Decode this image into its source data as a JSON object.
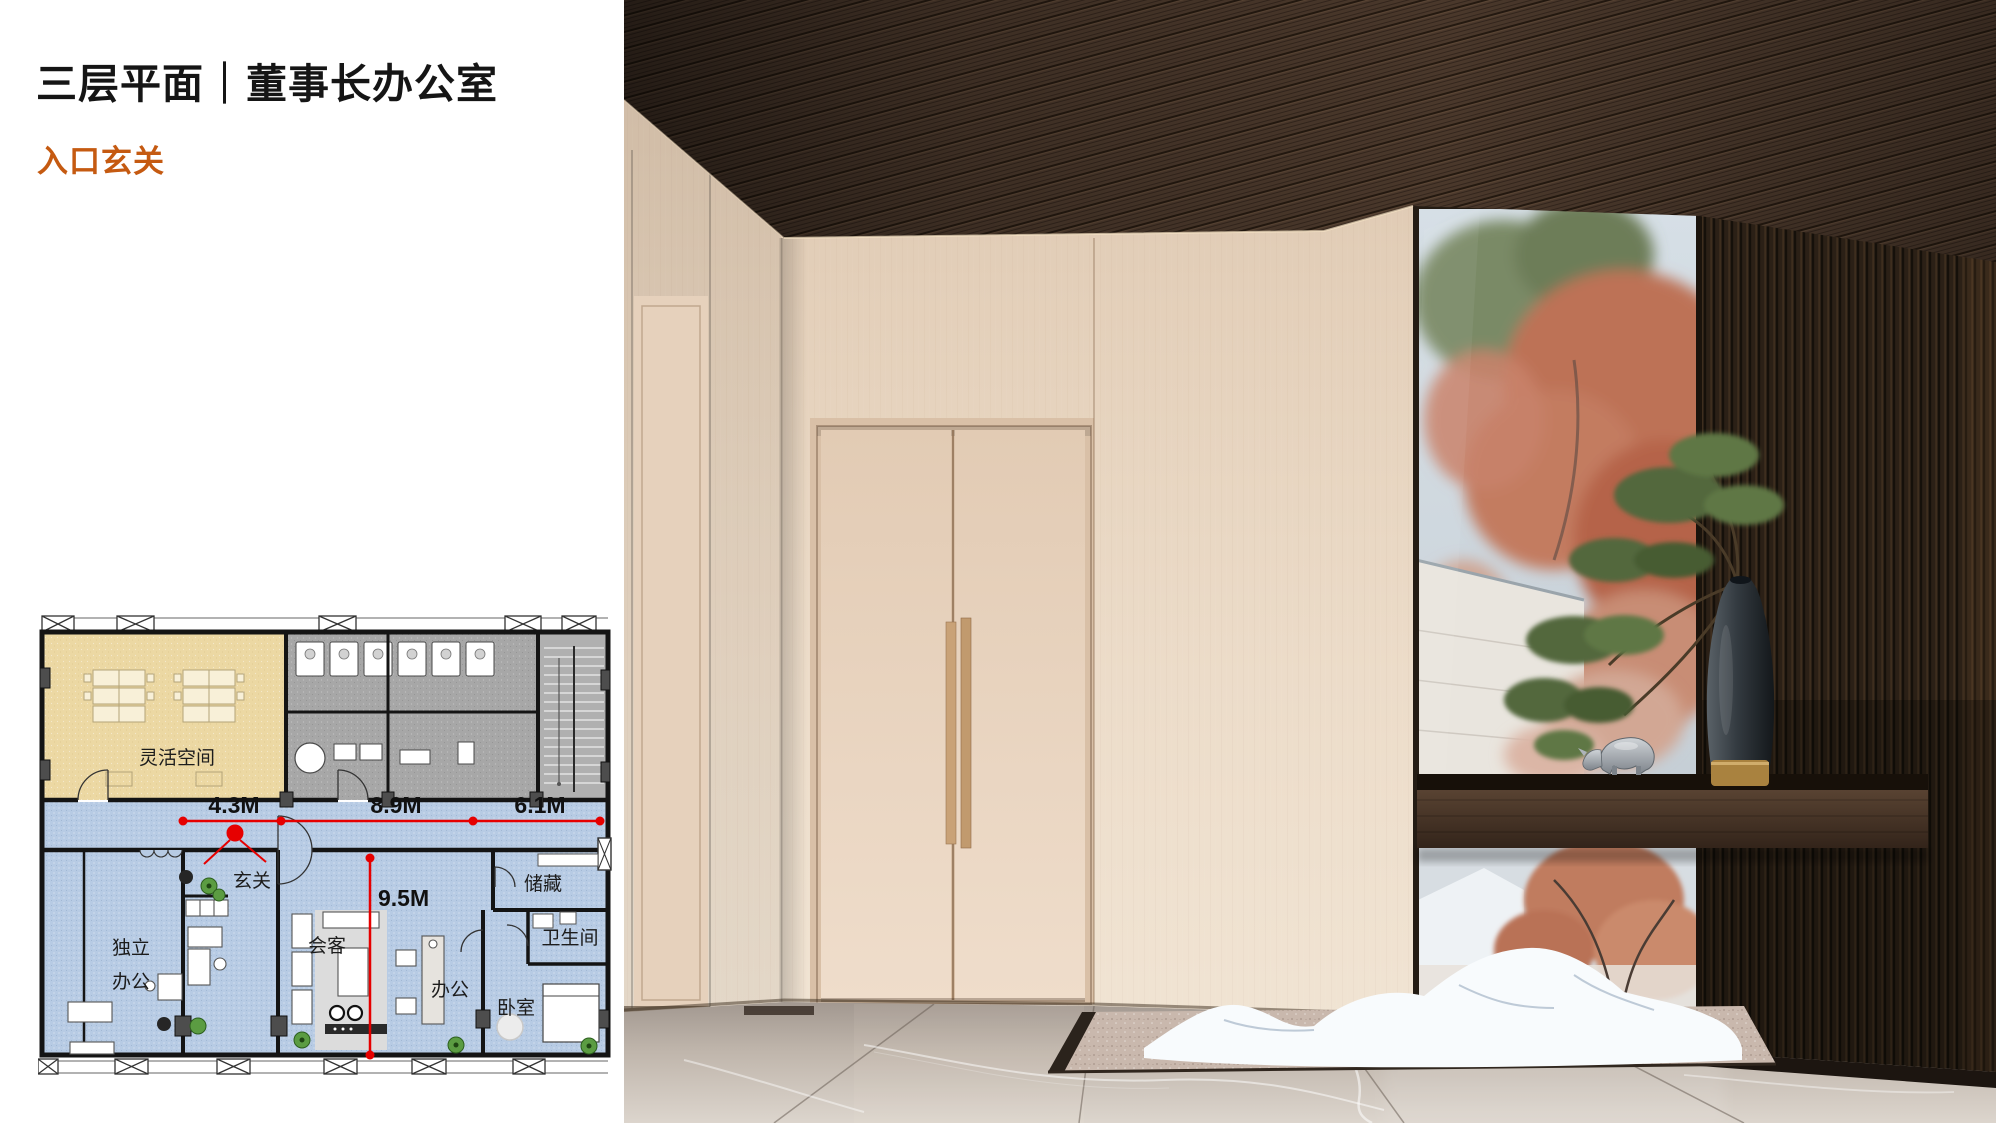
{
  "header": {
    "title": "三层平面｜董事长办公室",
    "subtitle": "入口玄关"
  },
  "floorplan": {
    "rooms": {
      "flex_space": "灵活空间",
      "entry": "玄关",
      "private_office_line1": "独立",
      "private_office_line2": "办公",
      "meeting": "会客",
      "office": "办公",
      "bedroom": "卧室",
      "bathroom": "卫生间",
      "storage": "储藏"
    },
    "dimensions": {
      "width_left": "4.3M",
      "width_middle": "8.9M",
      "width_right": "6.1M",
      "depth": "9.5M"
    }
  },
  "palette": {
    "accent_orange": "#C55A11",
    "dimension_red": "#E60000",
    "plan_blue": "#B7CBE4",
    "plan_beige": "#ECD8A3",
    "plan_gray": "#A7A7A7",
    "wood_ceiling": "#4A382B",
    "wood_wall": "#E8D6C2",
    "slat_wall": "#2B2016",
    "marble_floor": "#C9C0B7"
  }
}
